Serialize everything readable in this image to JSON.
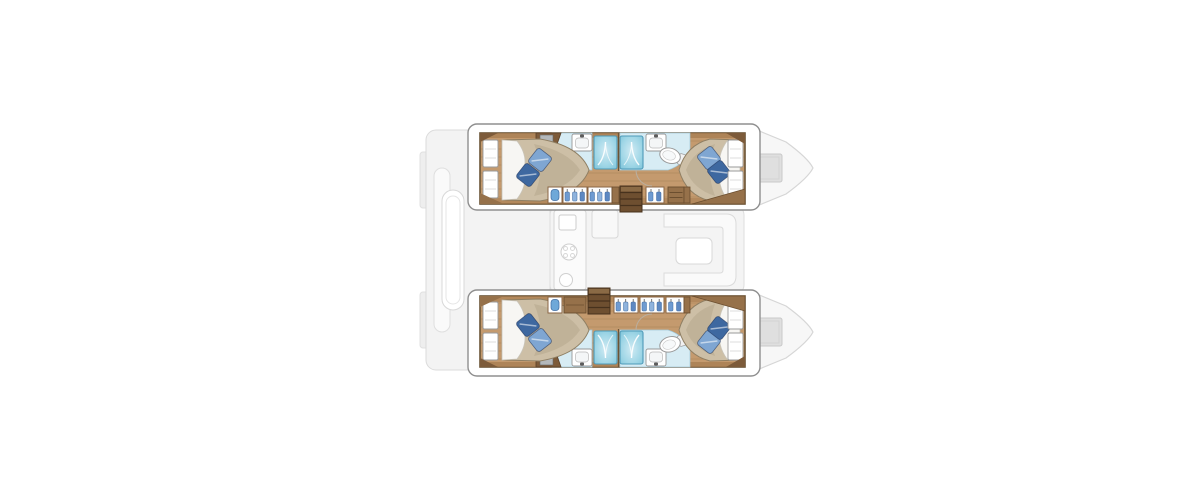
{
  "canvas": {
    "width": 1200,
    "height": 500,
    "background": "#ffffff"
  },
  "subject": {
    "kind": "catamaran yacht interior floor plan, top-down view",
    "vessel_type": "catamaran",
    "bow_direction": "right",
    "hulls": 2,
    "cabins": 4,
    "bathrooms": 4,
    "berths": "4 double beds"
  },
  "palette": {
    "background": "#ffffff",
    "wood_floor": "#c49a6e",
    "wood_plank_line": "#a5834f",
    "wood_trim_dark": "#7d5b3a",
    "cabinet_wood": "#96714a",
    "stair_wood": "#6e4f30",
    "mattress": "#cdbfa6",
    "mattress_shade": "#b7a78c",
    "sheet_white": "#f7f6f3",
    "pillow_dark_blue": "#3e68a0",
    "pillow_light_blue": "#7fa6d2",
    "shower_blue": "#9fd6e6",
    "shower_highlight": "#cfeaf3",
    "shower_border": "#4e9ab8",
    "bathroom_floor": "#d7ecf4",
    "fixture_white": "#ffffff",
    "faded_deck_fill": "#f3f3f3",
    "faded_deck_stroke": "#d8d8d8",
    "hatch_gray": "#dcdcdc",
    "hull_outline": "#6b5436"
  },
  "rooms": {
    "cockpit": "Aft cockpit with bench seats and table (deck level, faded)",
    "saloon": "Saloon with galley, stove, sink and lounge seating (deck level, faded)",
    "bow_deck_upper": "Upper hull bow deck with hatch (faded)",
    "bow_deck_lower": "Lower hull bow deck with hatch (faded)",
    "hull_upper": "Upper hull: aft double cabin, two shower bathrooms, corridor with lockers, forward double cabin",
    "hull_lower": "Lower hull: aft double cabin, two shower bathrooms, corridor with lockers, forward double cabin",
    "aft_cabin": "Aft double cabin with bed, two pillows and headboard shelves",
    "forward_cabin": "Forward double cabin with bed, two pillows and headboard shelves",
    "aft_bathroom": "Aft bathroom: shower, washbasin, toilet",
    "forward_bathroom": "Forward bathroom: shower, washbasin, toilet",
    "corridor_upper": "Upper hull corridor wall: basin cabinet, hanging lockers, companionway stairs, drawers",
    "corridor_lower": "Lower hull corridor wall: basin cabinet, counter, companionway stairs, hanging lockers"
  },
  "fixtures": {
    "per_hull": [
      "double-bed",
      "pillow x2",
      "headboard-shelves x2",
      "tv-cabinet",
      "shower x2",
      "washbasin x2",
      "toilet x2",
      "hanging-locker x3",
      "companionway-stairs",
      "drawer-unit",
      "washbasin-cabinet"
    ],
    "deck_level": [
      "transom-steps x2",
      "cockpit-bench",
      "cockpit-table",
      "galley-counter",
      "galley-sink",
      "stove",
      "galley-basin",
      "saloon-sofa",
      "saloon-table",
      "bow-hatch x2"
    ]
  }
}
